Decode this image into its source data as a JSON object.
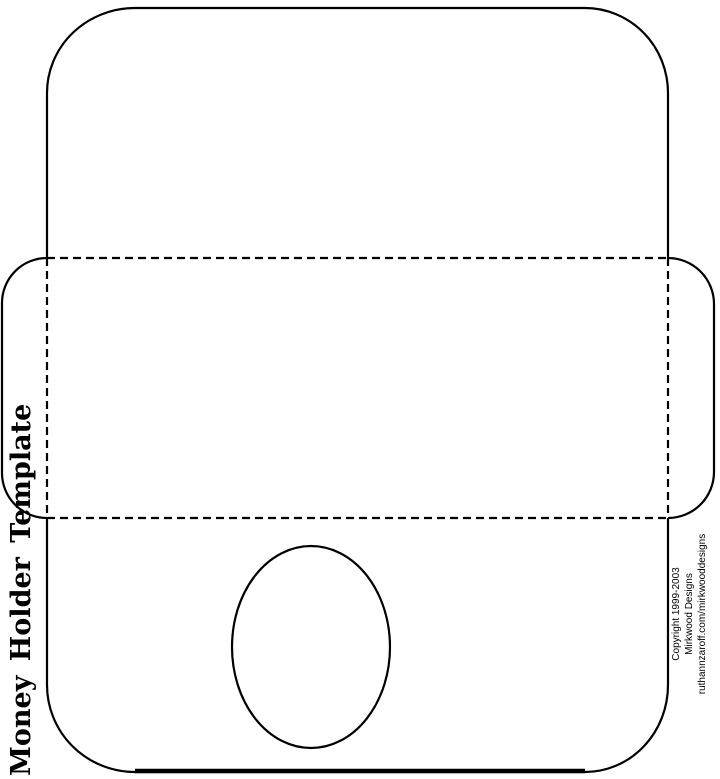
{
  "title": {
    "text": "Money Holder Template"
  },
  "credits": {
    "lines": [
      "Copyright 1999-2003",
      "Mirkwood Designs",
      "ruthannzaroff.com/mirkwooddesigns"
    ]
  },
  "colors": {
    "ink": "#000000",
    "paper": "#ffffff"
  }
}
